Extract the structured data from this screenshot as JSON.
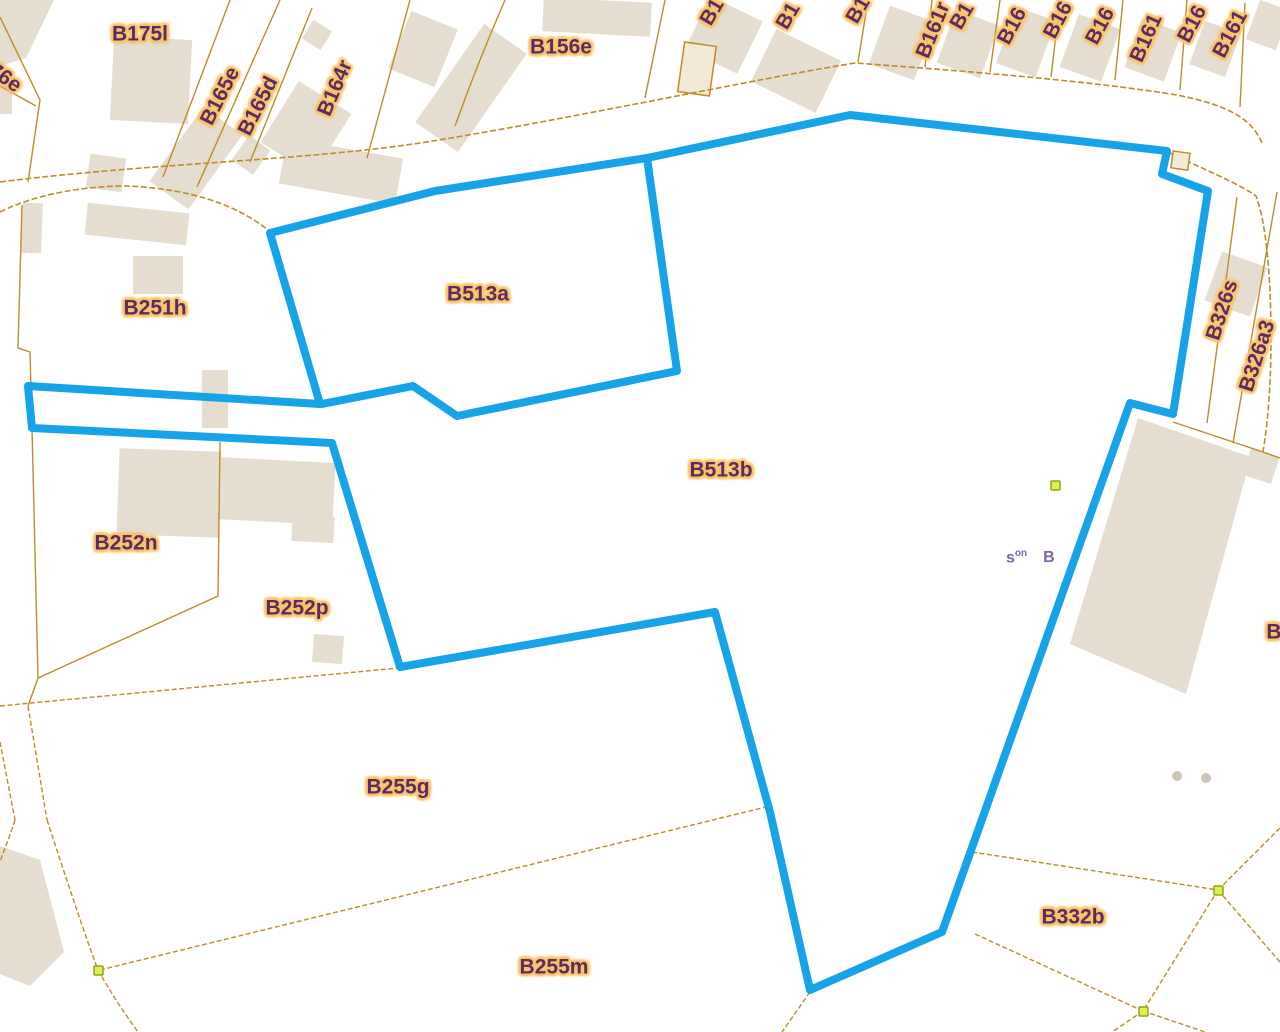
{
  "map": {
    "type": "cadastral-parcel-map",
    "selected_parcels": [
      "B513a",
      "B513b"
    ]
  },
  "labels": {
    "b176e": "B176e",
    "b175l": "B175l",
    "b165e": "B165e",
    "b165d": "B165d",
    "b164r": "B164r",
    "b156e": "B156e",
    "b251h": "B251h",
    "b252n": "B252n",
    "b252p": "B252p",
    "b513a": "B513a",
    "b513b": "B513b",
    "b255g": "B255g",
    "b255m": "B255m",
    "b332b": "B332b",
    "b326s": "B326s",
    "b326a3": "B326a3",
    "right_edge_partial": "B"
  },
  "top_labels": [
    "B1",
    "B1",
    "B1",
    "B161r",
    "B1",
    "B16",
    "B16",
    "B16",
    "B161",
    "B16",
    "B161"
  ],
  "annotation": {
    "prefix": "s",
    "sup": "on",
    "suffix": "B"
  },
  "colors": {
    "blue": "#17a3e8",
    "line": "#c08b28",
    "lbltext": "#5d2a63",
    "halo": "#f9c468",
    "bld": "#e4ddd0",
    "marker": "#ddf04f",
    "annot": "#7c64ab"
  }
}
